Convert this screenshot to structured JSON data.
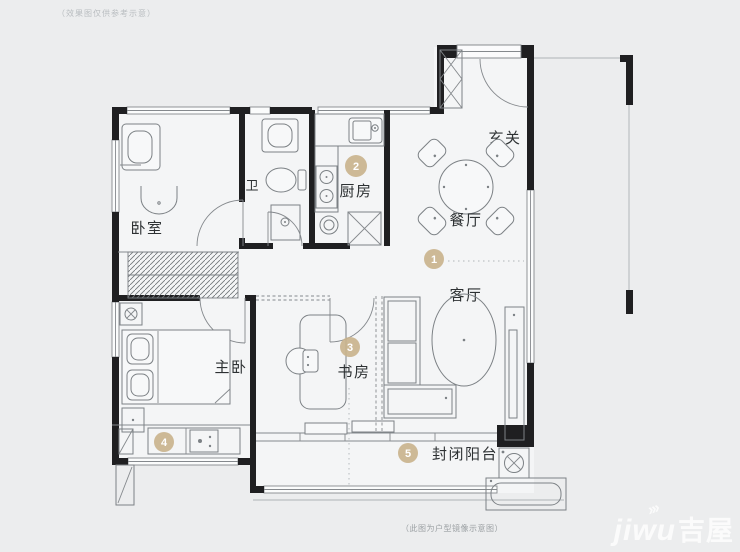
{
  "colors": {
    "background": "#ecedee",
    "floor": "#f4f5f6",
    "wall": "#1f1f21",
    "outline": "#7c8185",
    "marker_fill": "#c9b28c",
    "marker_text": "#ffffff",
    "label_text": "#2d3133",
    "watermark_text": "#ffffff"
  },
  "annotations": {
    "top_note": "（效果图仅供参考示意）",
    "bottom_caption": "（此图为户型镜像示意图）"
  },
  "rooms": {
    "bedroom": {
      "label": "卧室"
    },
    "bathroom": {
      "label": "卫"
    },
    "kitchen": {
      "label": "厨房",
      "marker": "2"
    },
    "entry": {
      "label": "玄关"
    },
    "dining": {
      "label": "餐厅"
    },
    "living": {
      "label": "客厅",
      "marker": "1"
    },
    "master_bedroom": {
      "label": "主卧"
    },
    "study": {
      "label": "书房",
      "marker": "3"
    },
    "utility": {
      "marker": "4"
    },
    "balcony": {
      "label": "封闭阳台",
      "marker": "5"
    }
  },
  "watermark": {
    "latin": "jiwu",
    "cjk": "吉屋"
  }
}
